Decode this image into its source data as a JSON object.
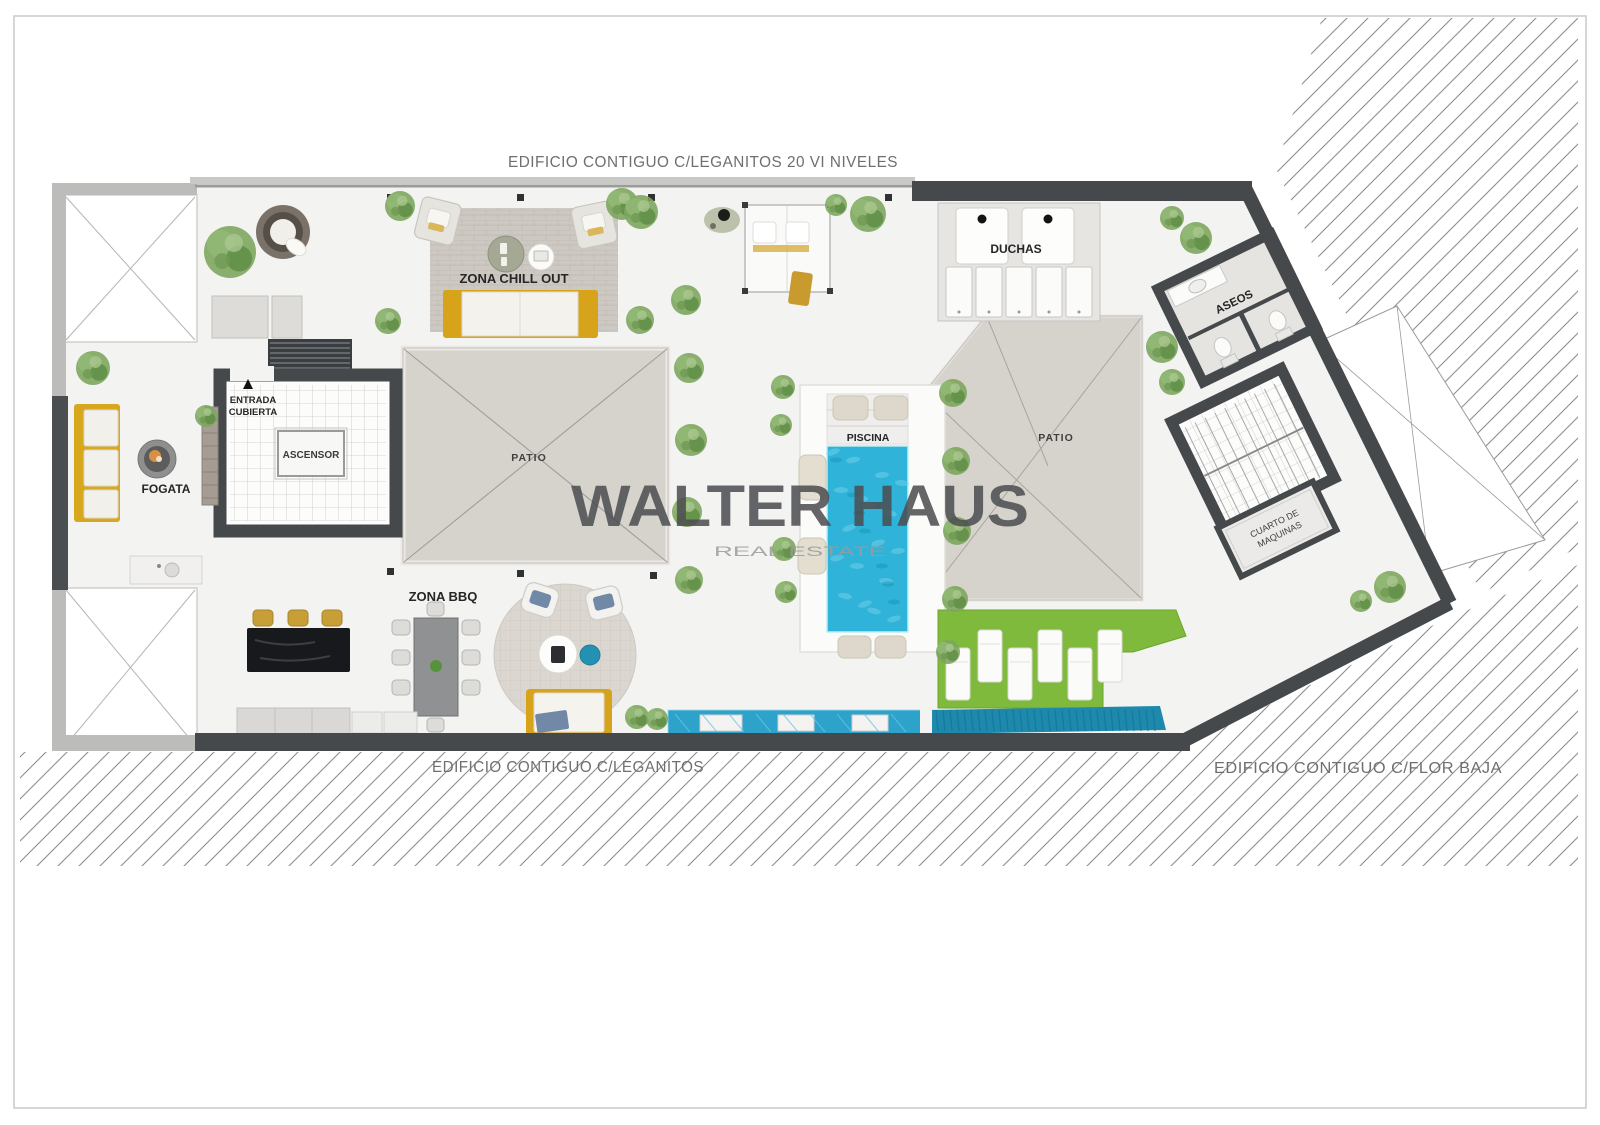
{
  "plan": {
    "adjacent_top": "EDIFICIO CONTIGUO C/LEGANITOS 20 VI NIVELES",
    "adjacent_bottom": "EDIFICIO CONTIGUO C/LEGANITOS",
    "adjacent_right": "EDIFICIO CONTIGUO C/FLOR BAJA",
    "rooms": {
      "zona_chill_out": "ZONA CHILL OUT",
      "duchas": "DUCHAS",
      "aseos": "ASEOS",
      "piscina": "PISCINA",
      "patio_left": "PATIO",
      "patio_right": "PATIO",
      "ascensor": "ASCENSOR",
      "entrada_line1": "ENTRADA",
      "entrada_line2": "CUBIERTA",
      "fogata": "FOGATA",
      "zona_bbq": "ZONA BBQ",
      "cuarto_line1": "CUARTO DE",
      "cuarto_line2": "MAQUINAS"
    }
  },
  "watermark": {
    "brand": "WALTER HAUS",
    "tagline": "REAL ESTATE"
  },
  "colors": {
    "wall_dark": "#45494c",
    "wall_light": "#bcbcba",
    "pool": "#2fb3d9",
    "channel": "#2da3cb",
    "channel_deep": "#1f89ad",
    "lawn": "#7fba3c",
    "sofa_yellow": "#d7a31b",
    "patio_gray": "#d6d3cd",
    "hatch_line": "#8d8d8d"
  }
}
